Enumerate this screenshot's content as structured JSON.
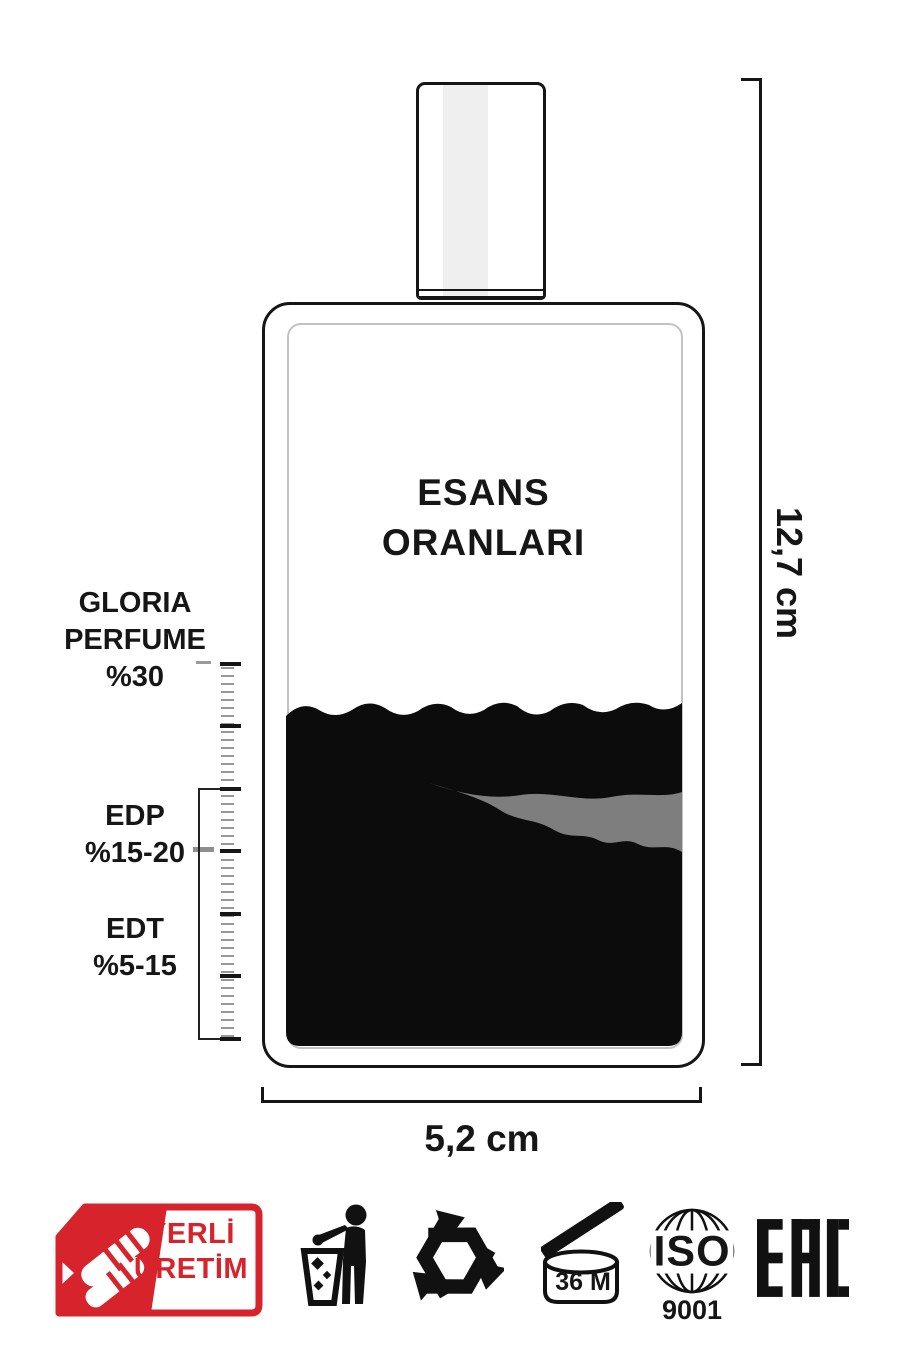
{
  "title": {
    "line1": "ESANS",
    "line2": "ORANLARI"
  },
  "labels": {
    "gloria": {
      "line1": "GLORIA",
      "line2": "PERFUME",
      "line3": "%30"
    },
    "edp": {
      "line1": "EDP",
      "line2": "%15-20"
    },
    "edt": {
      "line1": "EDT",
      "line2": "%5-15"
    }
  },
  "dimensions": {
    "height": "12,7 cm",
    "width": "5,2 cm"
  },
  "badge": {
    "line1": "YERLİ",
    "line2": "ÜRETİM",
    "color": "#D7232B"
  },
  "icons": {
    "tidyman": "tidyman-disposal-icon",
    "recycle": "recycling-icon",
    "pao_label": "36 M",
    "iso_title": "ISO",
    "iso_number": "9001",
    "eac_label": "EAC"
  },
  "colors": {
    "ink": "#161616",
    "liquid": "#0c0c0c",
    "streak": "#7e7e7e",
    "inner_border": "#c2c2c2",
    "accent_red": "#D7232B"
  }
}
